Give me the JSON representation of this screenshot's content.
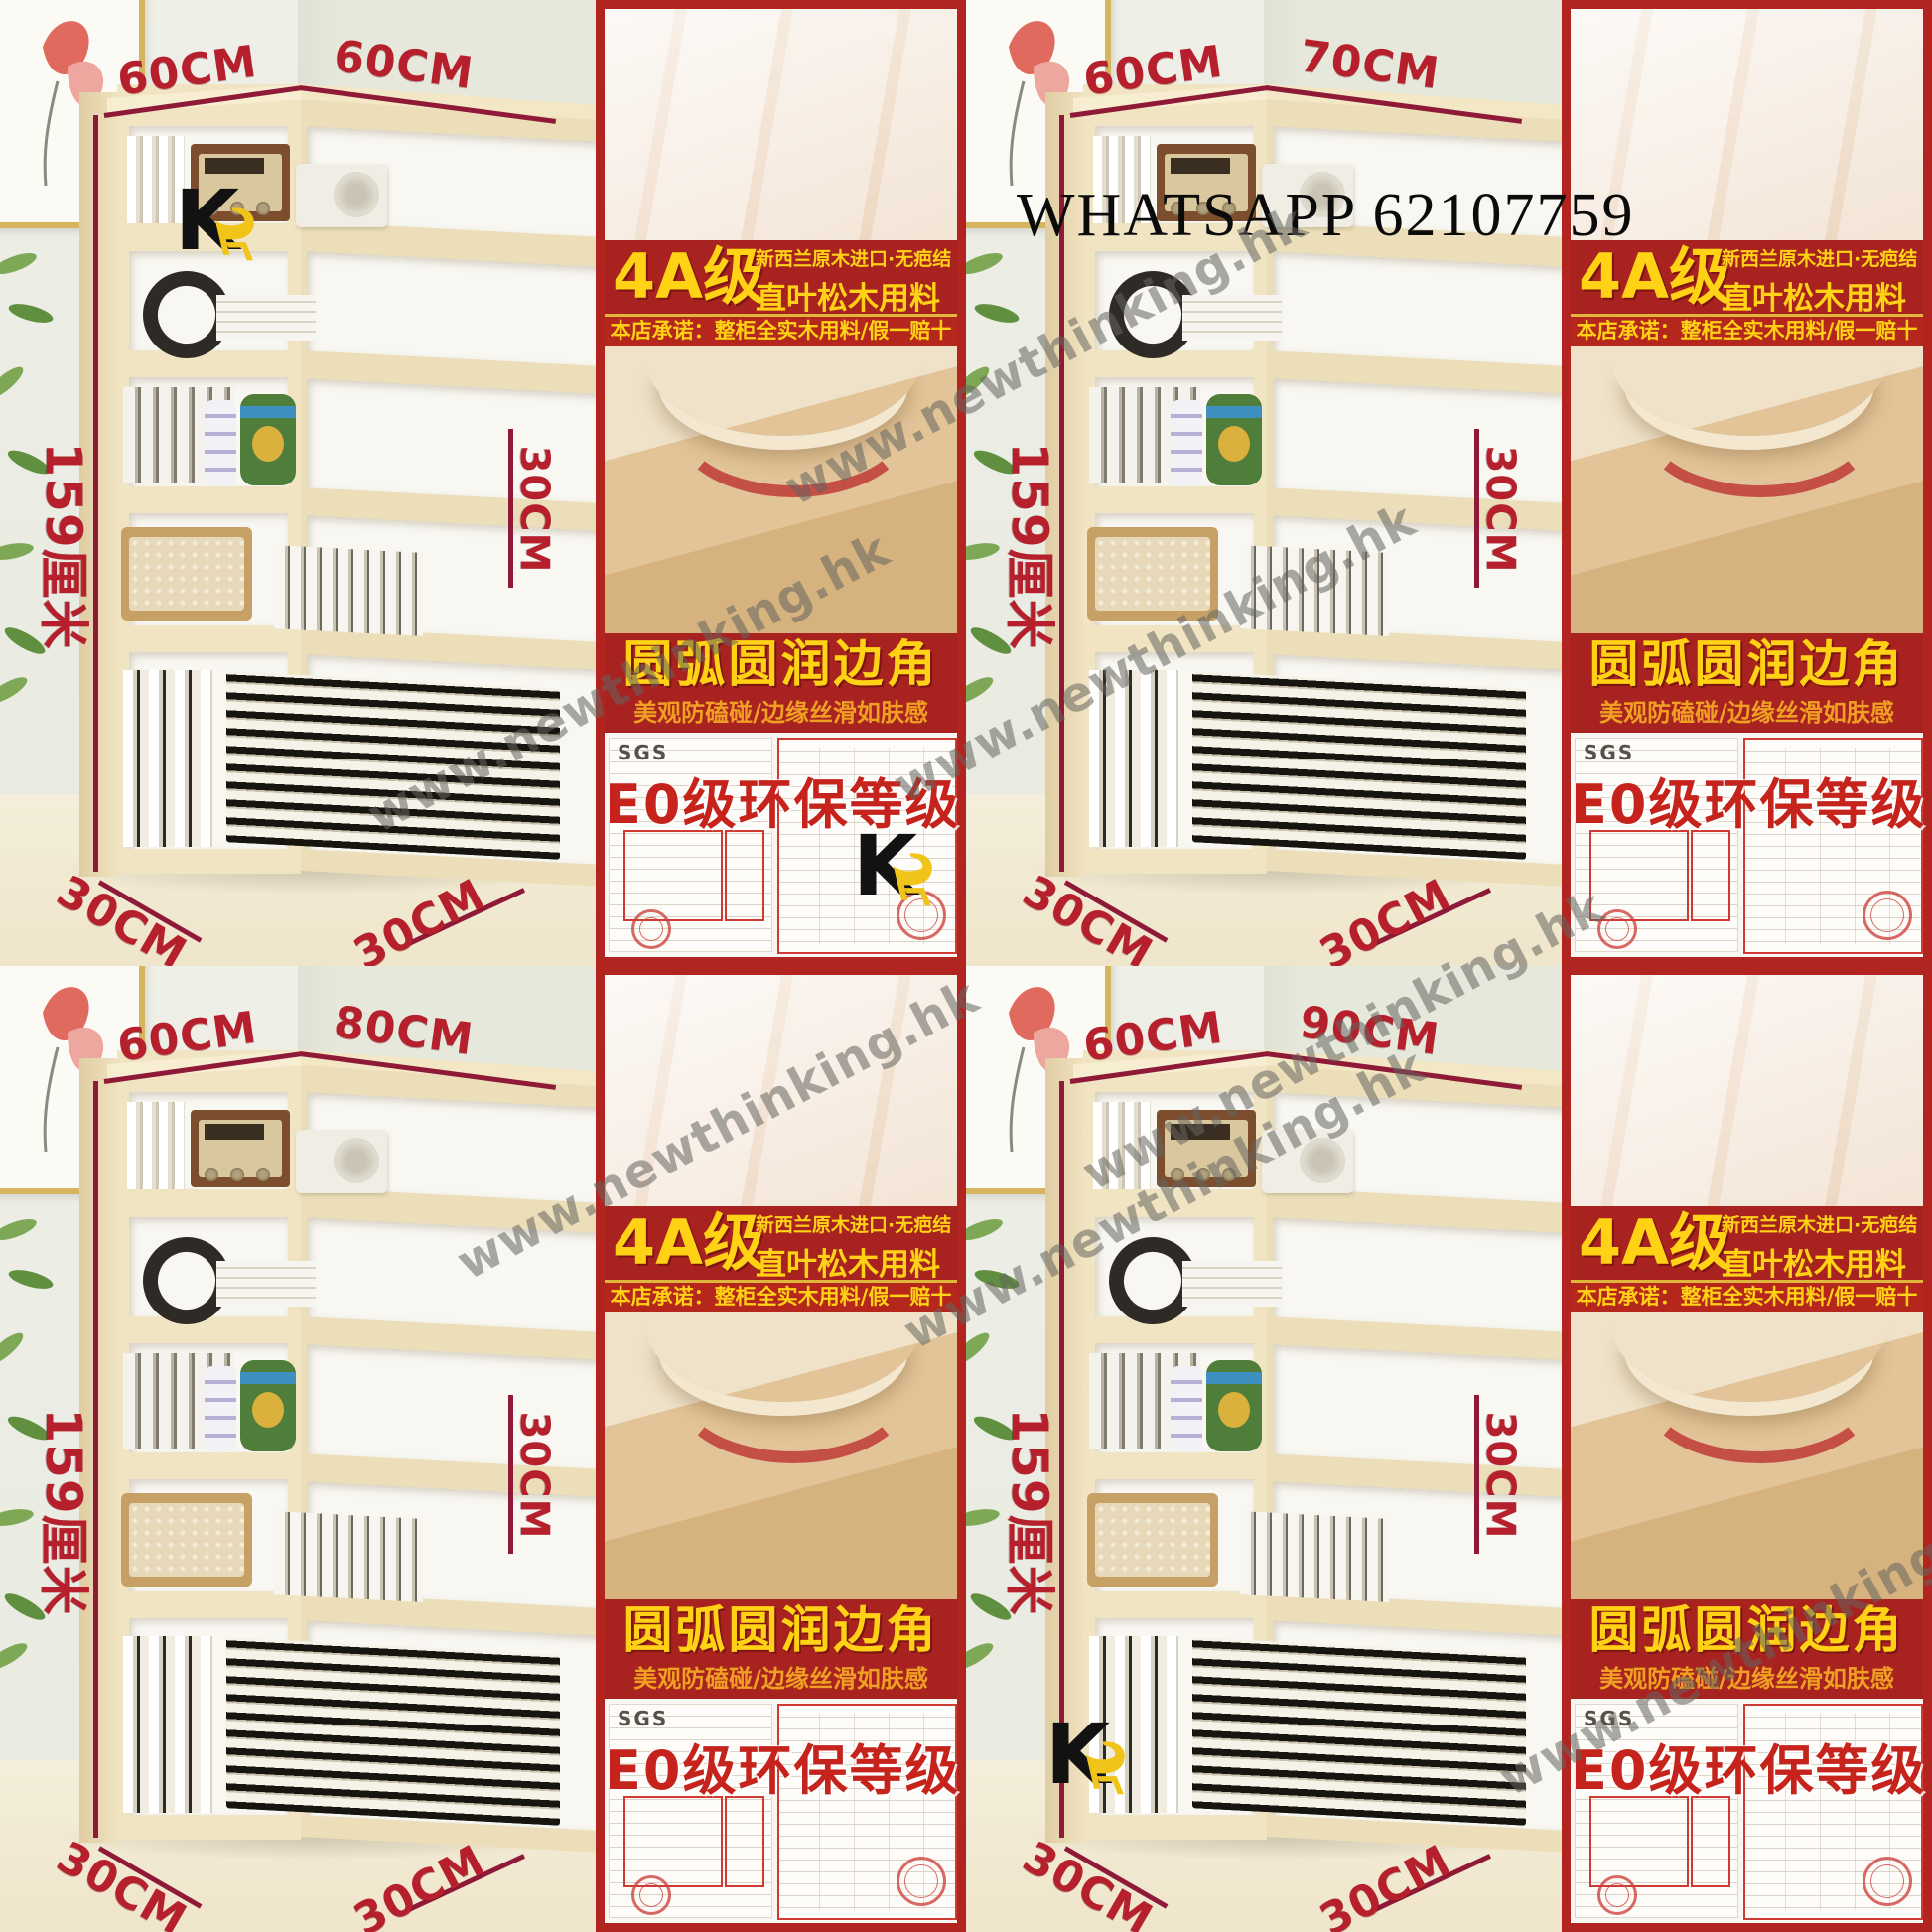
{
  "page": {
    "whatsapp_overlay": "WHATSAPP 62107759",
    "watermark_text": "www.newthinking.hk"
  },
  "brand": {
    "logo_letter": "K"
  },
  "panel": {
    "grade_badge": "4A级",
    "grade_line1": "新西兰原木进口·无疤结",
    "grade_line2": "直叶松木用料",
    "promise": "本店承诺：整柜全实木用料/假一赔十",
    "edge_title": "圆弧圆润边角",
    "edge_subtitle": "美观防磕碰/边缘丝滑如肤感",
    "eco_title": "E0级环保等级",
    "sgs_label": "SGS"
  },
  "quadrants": [
    {
      "variant": "60CM x 60CM",
      "dim_top_left": "60CM",
      "dim_top_right": "60CM",
      "dim_height": "159厘米",
      "dim_depth": "30CM",
      "dim_bottom_left": "30CM",
      "dim_bottom_right": "30CM",
      "logo_on_shelf_top": true,
      "logo_on_shelf_bottom": false,
      "logo_on_cert": true
    },
    {
      "variant": "60CM x 70CM",
      "dim_top_left": "60CM",
      "dim_top_right": "70CM",
      "dim_height": "159厘米",
      "dim_depth": "30CM",
      "dim_bottom_left": "30CM",
      "dim_bottom_right": "30CM",
      "logo_on_shelf_top": false,
      "logo_on_shelf_bottom": false,
      "logo_on_cert": false
    },
    {
      "variant": "60CM x 80CM",
      "dim_top_left": "60CM",
      "dim_top_right": "80CM",
      "dim_height": "159厘米",
      "dim_depth": "30CM",
      "dim_bottom_left": "30CM",
      "dim_bottom_right": "30CM",
      "logo_on_shelf_top": false,
      "logo_on_shelf_bottom": false,
      "logo_on_cert": false
    },
    {
      "variant": "60CM x 90CM",
      "dim_top_left": "60CM",
      "dim_top_right": "90CM",
      "dim_height": "159厘米",
      "dim_depth": "30CM",
      "dim_bottom_left": "30CM",
      "dim_bottom_right": "30CM",
      "logo_on_shelf_top": false,
      "logo_on_shelf_bottom": true,
      "logo_on_cert": false
    }
  ],
  "colors": {
    "dimension_label_red": "#b6202c",
    "dimension_line_red": "#8e1a38",
    "banner_red": "#a82220",
    "accent_yellow": "#ffd215",
    "subtitle_orange": "#ef9f23",
    "eco_red": "#c5231c",
    "logo_chair_yellow": "#f0c419",
    "wood_light": "#f1e4c3"
  }
}
